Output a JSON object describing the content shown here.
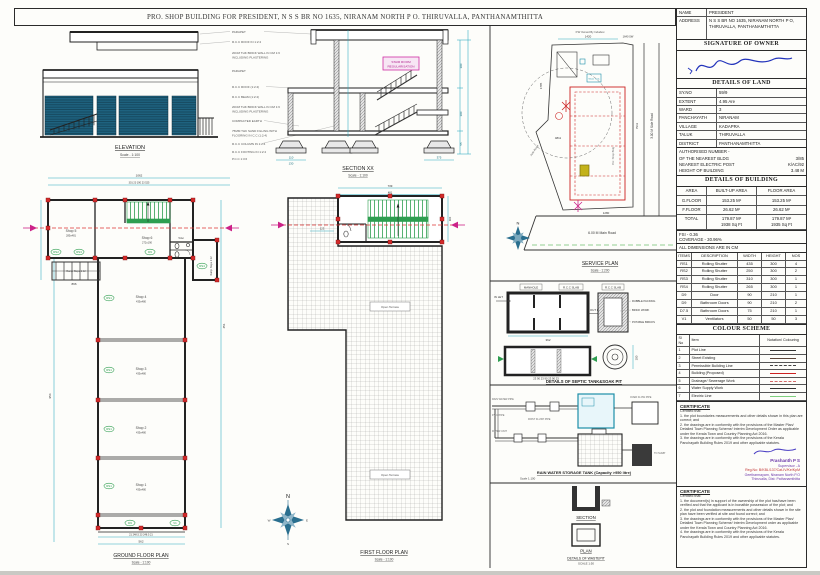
{
  "page": {
    "title": "PRO. SHOP BUILDING FOR PRESIDENT, N S S BR NO 1635, NIRANAM NORTH  P O.  THIRUVALLA, PANTHANAMTHITTA"
  },
  "owner": {
    "name_label": "NAME",
    "name": "PRESIDENT",
    "address_label": "ADDRESS",
    "address": "N S S BR NO 1635, NIRANAM NORTH P O, THIRUVALLA, PANTHANAMTHITTA",
    "signature_header": "SIGNATURE OF OWNER"
  },
  "land": {
    "header": "DETAILS OF LAND",
    "rows": [
      {
        "label": "SY.NO",
        "value": "59/9"
      },
      {
        "label": "EXTENT",
        "value": "4.95 Are"
      },
      {
        "label": "WARD",
        "value": "3"
      },
      {
        "label": "PANCHAYATH",
        "value": "NIRANAM"
      },
      {
        "label": "VILLAGE",
        "value": "KADAPRA"
      },
      {
        "label": "TALUK",
        "value": "THIRUVALLA"
      },
      {
        "label": "DISTRICT",
        "value": "PANTHANAMTHITTA"
      }
    ],
    "notes": [
      {
        "label": "AUTHORISED NUMBER -",
        "value": ""
      },
      {
        "label": "OF THE NEAREST BLDG",
        "value": "3/85"
      },
      {
        "label": "NEAREST ELECTRIC POST",
        "value": "K/AC/92"
      },
      {
        "label": "HEIGHT OF BUILDING",
        "value": "3.48 M"
      }
    ]
  },
  "building": {
    "header": "DETAILS OF BUILDING",
    "cols": [
      "AREA",
      "BUILT-UP AREA",
      "FLOOR AREA"
    ],
    "rows": [
      {
        "area": "G.FLOOR",
        "built": "153.25 M²",
        "floor": "153.25 M²"
      },
      {
        "area": "F.FLOOR",
        "built": "26.62 M²",
        "floor": "26.62 M²"
      },
      {
        "area": "TOTAL",
        "built": "179.87 M²",
        "floor": "179.87 M²",
        "built2": "1938 Sq Ft",
        "floor2": "1935 Sq Ft"
      }
    ],
    "fsi": "FSI - 0.36",
    "coverage": "COVERAGE - 30.96%",
    "dims_note": "ALL DIMENSIONS ARE IN CM"
  },
  "items": {
    "headers": [
      "ITEMS",
      "DESCRIPTION",
      "WIDTH",
      "HEIGHT",
      "NOS"
    ],
    "rows": [
      [
        "RS1",
        "Rolling Shutter",
        "435",
        "300",
        "4"
      ],
      [
        "RS2",
        "Rolling Shutter",
        "250",
        "300",
        "2"
      ],
      [
        "RS3",
        "Rolling Shutter",
        "310",
        "300",
        "1"
      ],
      [
        "RS4",
        "Rolling Shutter",
        "265",
        "300",
        "1"
      ],
      [
        "D9",
        "Door",
        "90",
        "210",
        "1"
      ],
      [
        "D9",
        "Bathroom Doors",
        "90",
        "210",
        "2"
      ],
      [
        "D7.5",
        "Bathroom Doors",
        "75",
        "210",
        "1"
      ],
      [
        "V1",
        "Ventilators",
        "50",
        "50",
        "3"
      ]
    ]
  },
  "colour_scheme": {
    "header": "COLOUR SCHEME",
    "cols": [
      "Sl No",
      "Item",
      "Notation/ Colouring"
    ],
    "rows": [
      {
        "no": "1",
        "item": "Plot Line",
        "color": "#333333",
        "dash": "solid"
      },
      {
        "no": "2",
        "item": "Street Existing",
        "color": "#5a4438",
        "dash": "solid"
      },
      {
        "no": "3",
        "item": "Permissible Building Line",
        "color": "#444444",
        "dash": "dashed"
      },
      {
        "no": "4",
        "item": "Building (Proposed)",
        "color": "#cc2222",
        "dash": "solid"
      },
      {
        "no": "5",
        "item": "Drainage/ Sewerage Work",
        "color": "#d46a6a",
        "dash": "dashed"
      },
      {
        "no": "6",
        "item": "Water Supply Work",
        "color": "#333333",
        "dash": "solid"
      },
      {
        "no": "7",
        "item": "Electric Line",
        "color": "#7ed07e",
        "dash": "solid"
      }
    ]
  },
  "certificate1": {
    "header": "CERTIFICATE",
    "intro": "Certified that:",
    "lines": [
      "1. the plot boundaries measurements and other details shown in this plan are correct; and",
      "2. the drawings are in conformity with the provisions of the Master Plan/ Detailed Town Planning Scheme/ Interim Development Order as applicable under the Kerala Town and Country Planning Act 2016.",
      "3. the drawings are in conformity with the provisions of the Kerala Panchayath Building Rules 2019 and other applicable statutes."
    ],
    "stamp": {
      "name": "Prashanth P S",
      "grade": "Supervisor - A",
      "reg": "Reg.No: B/KBL/137/Cat-IV/Ke/KpM",
      "addr1": "Geetharmayam, Niranam North P.O",
      "addr2": "Thiruvalla, Dist: Pathanamthitta"
    }
  },
  "certificate2": {
    "header": "CERTIFICATE",
    "intro": "Certified that:",
    "lines": [
      "1. the document(s) in support of the ownership of the plot has/have been verified and that the applicant is in bonafide possession of the plot; and",
      "2. the plot and foundation measurements and other details shown in the site plan have been verified at site and found correct; and",
      "3. the drawings are in conformity with the provisions of the Master Plan/ Detailed Town Planning Scheme/ Interim Development order as applicable under the Kerala Town and Country Planning Act 2016.",
      "4. the drawings are in conformity with the provisions of the Kerala Panchayath Building Rules 2019 and other applicable statutes."
    ]
  },
  "drawings": {
    "elevation": {
      "title": "ELEVATION",
      "scale": "Scale - 1:100"
    },
    "notes": [
      "PARAPET",
      "R.C.C ROOF IN 1:2:4",
      "20CM THK BRICK WALL IN CM 1:6",
      "INCLUDING PLASTERING",
      "PARAPET",
      "R.C.C ROOF (1:2:4)",
      "R.C.C BEAM (1:2:4)",
      "20CM THK BRICK WALL IN CM 1:6",
      "INCLUDING PLASTERING",
      "COMPACTED EARTH",
      "75MM THK SAND FILLING WITH",
      "FLOORING IN C.C (1:2:4)",
      "R.C.C COLUMN IN 1:2:4",
      "R.C.C FOOTING IN 1:2:4",
      "P.C.C 1:3:6"
    ],
    "section": {
      "title": "SECTION XX",
      "scale": "Scale - 1:100",
      "tag_line1": "STAIR ROOM",
      "tag_line2": "REGULARISATION",
      "dims": {
        "b_left1": "110",
        "b_left2": "130",
        "b_right": "375",
        "r1": "300",
        "r2": "300",
        "r3": "55"
      }
    },
    "service_plan": {
      "title": "SERVICE PLAN",
      "scale": "Scale - 1:200",
      "owned_by": "P.W Owned By Indudevi",
      "main_road": "6.00 M Main Road",
      "side_road": "3.00 M Side Road",
      "auto_road": "Auto Road",
      "bldg_label": "Pro: Shop Bldg",
      "water_tank": "Water Tank",
      "dims": {
        "top": "1420",
        "top_right": "1640 SW",
        "left": "1785",
        "mid": "4811",
        "bottom": "1280",
        "right": "7911"
      }
    },
    "ground_floor": {
      "title": "GROUND FLOOR PLAN",
      "scale": "Scale - 1:100",
      "rooms": [
        {
          "name": "Shop 5",
          "size": "285x481"
        },
        {
          "name": "Shop 6",
          "size": "272x190"
        },
        {
          "name": "Shop 4",
          "size": "435x480"
        },
        {
          "name": "Shop 3",
          "size": "435x480"
        },
        {
          "name": "Shop 2",
          "size": "435x480"
        },
        {
          "name": "Shop 1",
          "size": "435x480"
        }
      ],
      "toilet": "Toilet",
      "ramp_left": "Ramp Slope 1:12",
      "ramp_right": "Ramp Slope 1:12",
      "tags": [
        "RS2",
        "RS3",
        "D9",
        "RS4",
        "RS1",
        "RS1",
        "RS1",
        "RS1",
        "D9",
        "V1"
      ],
      "dims": {
        "top_total": "1062",
        "top_segs": "301   23   190   23   525",
        "left": "896",
        "right": "954",
        "right2": "451",
        "bottom_segs": "21   248.5   23   248.5   21",
        "bottom_total": "562"
      }
    },
    "first_floor": {
      "title": "FIRST FLOOR PLAN",
      "scale": "Scale - 1:100",
      "terrace": "Open Terrace",
      "dims": {
        "top": "739",
        "top2": "481",
        "a": "243",
        "b": "156",
        "c": "123",
        "right": "300"
      }
    },
    "septic": {
      "title": "DETAILS OF SEPTIC TANK&SOAK PIT",
      "manhole": "MANHOLE",
      "rcc_slab": "R.C.C SLAB",
      "rcc_slab2": "R.C.C SLAB",
      "inlet": "IN LET",
      "outlet": "OUT LET",
      "rubble": "RUBBLE PACKING",
      "brick": "BRICK WORK",
      "potable": "POTABLE BRICKS",
      "dim_w": "362",
      "dim_segs": "23 90 23 90 23 90 23",
      "dim_d": "100"
    },
    "rainwater": {
      "title": "RAIN WATER STORAGE TANK (Capacity >950 litre)",
      "scale": "Scale 1:100",
      "pipe_labels": [
        "RAIN WATER PIPE",
        "P.V.C PIPE",
        "FIRST FLUSH PIPE",
        "FILTER UNIT",
        "OVER FLOW PIPE",
        "TO SUMP"
      ]
    },
    "wastepit": {
      "section": "SECTION",
      "plan": "PLAN",
      "title": "DETAILS OF WASTEPIT",
      "scale": "SCALE 1:50"
    },
    "compass": {
      "n": "N",
      "e": "E",
      "s": "S",
      "w": "W"
    }
  }
}
